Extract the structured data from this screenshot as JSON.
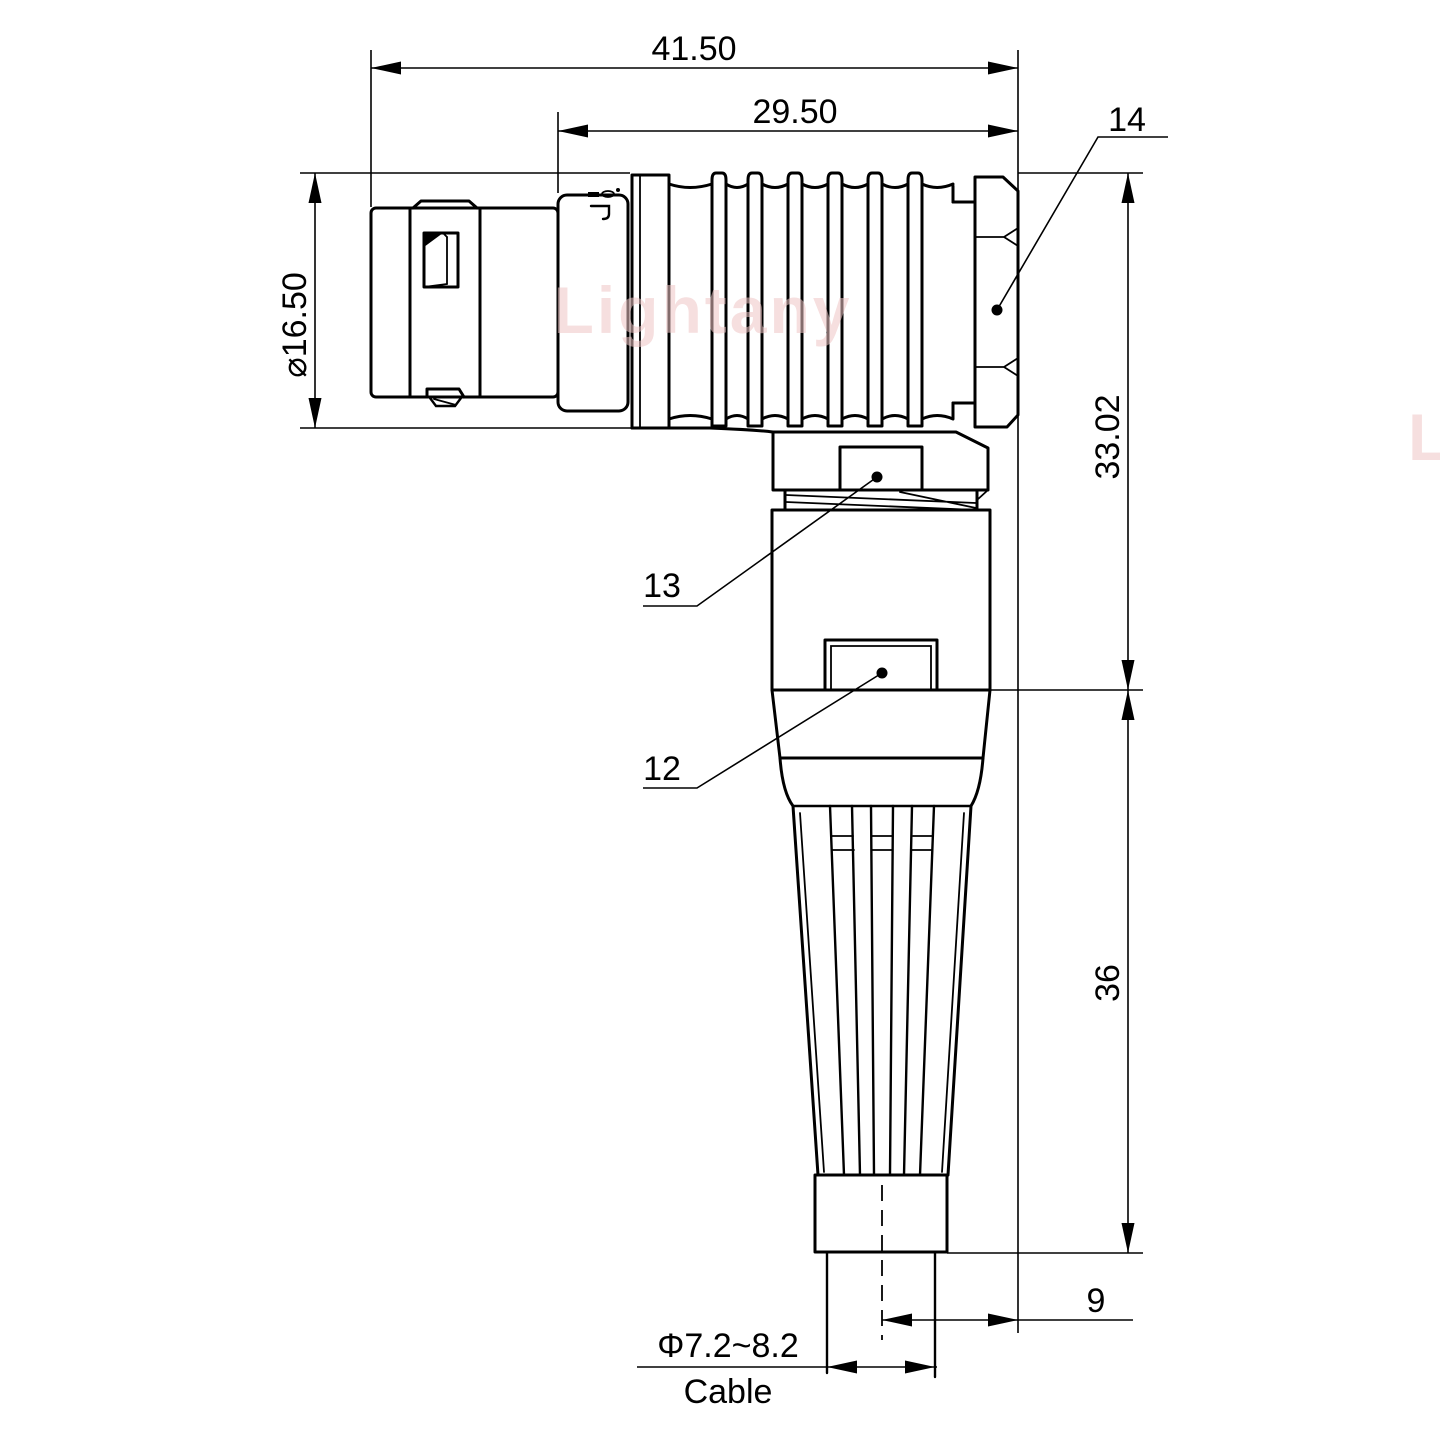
{
  "page": {
    "background": "#ffffff"
  },
  "watermark": {
    "text": "Lightany",
    "color": "#efc5c5"
  },
  "dimensions": {
    "overall_length": "41.50",
    "rear_section_length": "29.50",
    "shell_diameter": "⌀16.50",
    "elbow_height": "33.02",
    "boot_length": "36",
    "axis_to_rear_face": "9",
    "cable_diameter": "Φ7.2~8.2",
    "cable_label": "Cable"
  },
  "part_labels": {
    "hex_nut": "14",
    "coupling_collar": "13",
    "shell_body": "12"
  },
  "colors": {
    "line": "#000000",
    "text": "#000000"
  }
}
